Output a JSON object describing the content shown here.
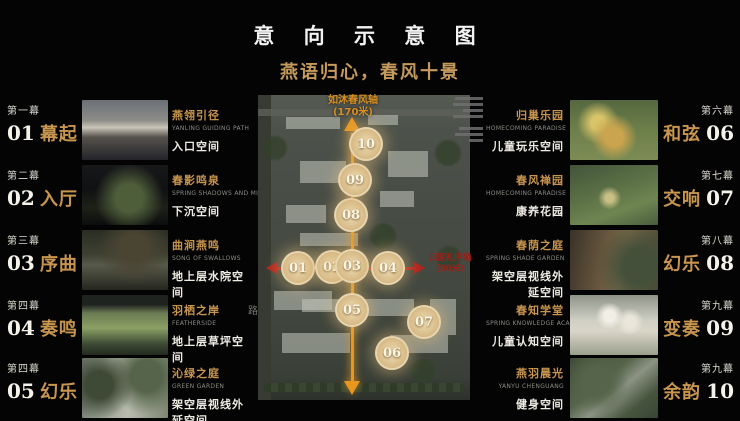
{
  "header": {
    "title": "意 向 示 意 图",
    "subtitle": "燕语归心，春风十景"
  },
  "left_scenes": [
    {
      "act": "第一幕",
      "num": "01",
      "act_name": "幕起",
      "feature": "燕翎引径",
      "feature_en": "YANLING GUIDING PATH",
      "space": "入口空间"
    },
    {
      "act": "第二幕",
      "num": "02",
      "act_name": "入厅",
      "feature": "春影鸣泉",
      "feature_en": "SPRING SHADOWS AND MINGQUAN",
      "space": "下沉空间"
    },
    {
      "act": "第三幕",
      "num": "03",
      "act_name": "序曲",
      "feature": "曲涧燕鸣",
      "feature_en": "SONG OF SWALLOWS",
      "space": "地上层水院空间"
    },
    {
      "act": "第四幕",
      "num": "04",
      "act_name": "奏鸣",
      "feature": "羽栖之岸",
      "feature_en": "FEATHERSIDE",
      "space": "地上层草坪空间"
    },
    {
      "act": "第四幕",
      "num": "05",
      "act_name": "幻乐",
      "feature": "沁绿之庭",
      "feature_en": "GREEN GARDEN",
      "space": "架空层视线外延空间"
    }
  ],
  "right_scenes": [
    {
      "act": "第六幕",
      "num": "06",
      "act_name": "和弦",
      "feature": "归巢乐园",
      "feature_en": "HOMECOMING PARADISE",
      "space": "儿童玩乐空间"
    },
    {
      "act": "第七幕",
      "num": "07",
      "act_name": "交响",
      "feature": "春风禅园",
      "feature_en": "HOMECOMING PARADISE",
      "space": "康养花园"
    },
    {
      "act": "第八幕",
      "num": "08",
      "act_name": "幻乐",
      "feature": "春荫之庭",
      "feature_en": "SPRING SHADE GARDEN",
      "space": "架空层视线外延空间"
    },
    {
      "act": "第九幕",
      "num": "09",
      "act_name": "变奏",
      "feature": "春知学堂",
      "feature_en": "SPRING KNOWLEDGE ACADEMY",
      "space": "儿童认知空间"
    },
    {
      "act": "第九幕",
      "num": "10",
      "act_name": "余韵",
      "feature": "燕羽晨光",
      "feature_en": "YANYU CHENGUANG",
      "space": "健身空间"
    }
  ],
  "map": {
    "vertical_axis_label": "如沐春风轴",
    "vertical_axis_length": "(170米)",
    "horizontal_axis_label": "归家礼序轴",
    "horizontal_axis_length": "(80米)",
    "road_label": "路",
    "markers": [
      "01",
      "02",
      "03",
      "04",
      "05",
      "06",
      "07",
      "08",
      "09",
      "10"
    ]
  },
  "colors": {
    "accent_gold": "#c8954f",
    "subtitle_gold": "#c59a5c",
    "axis_orange": "#e8971e",
    "axis_red": "#b3241e",
    "marker_fill": "#d9bd8a"
  }
}
